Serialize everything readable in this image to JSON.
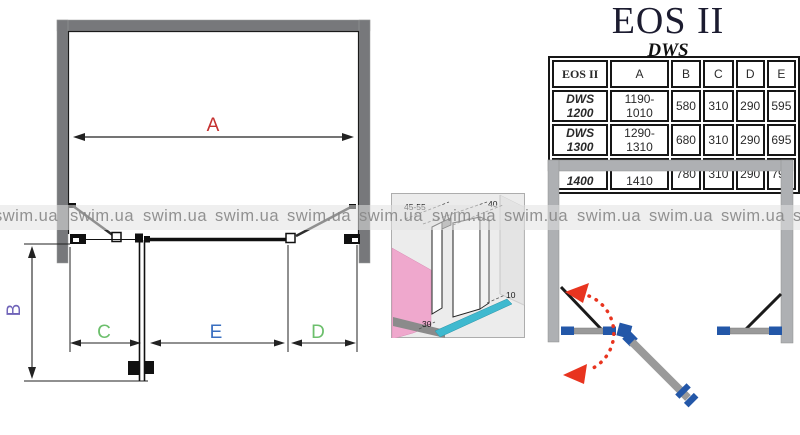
{
  "title": "EOS II",
  "subtitle": "DWS",
  "watermark": {
    "text": "swim.ua"
  },
  "table": {
    "headers": {
      "model": "EOS II",
      "a": "A",
      "b": "B",
      "c": "C",
      "d": "D",
      "e": "E"
    },
    "header_colors": {
      "a": "#c5302f",
      "b": "#4a7fd4",
      "c": "#5cb85c",
      "d": "#8fd694",
      "e": "#7a6fc8"
    },
    "rows": [
      {
        "model": "DWS 1200",
        "a": "1190-1010",
        "b": "580",
        "c": "310",
        "d": "290",
        "e": "595"
      },
      {
        "model": "DWS 1300",
        "a": "1290-1310",
        "b": "680",
        "c": "310",
        "d": "290",
        "e": "695"
      },
      {
        "model": "DWS 1400",
        "a": "1390-1410",
        "b": "780",
        "c": "310",
        "d": "290",
        "e": "795"
      }
    ]
  },
  "plan_diagram": {
    "labels": {
      "a": "A",
      "b": "B",
      "c": "C",
      "d": "D",
      "e": "E"
    },
    "label_colors": {
      "a": "#c5302f",
      "b": "#6f63b8",
      "c": "#6cbf6c",
      "d": "#6cbf6c",
      "e": "#3a6fc0"
    },
    "wall_color": "#77787b"
  },
  "detail_diagram": {
    "labels": {
      "top_left": "45-55",
      "top_right": "40",
      "right": "10",
      "bottom": "30"
    },
    "pink_wall_color": "#efa8cd",
    "glass_strip_color": "#3fb9cf"
  },
  "swing_diagram": {
    "wall_color": "#aeb0b3",
    "fitting_color": "#2357a8",
    "door_color": "#9a9a9a",
    "swing_arrow_color": "#e8341f"
  }
}
